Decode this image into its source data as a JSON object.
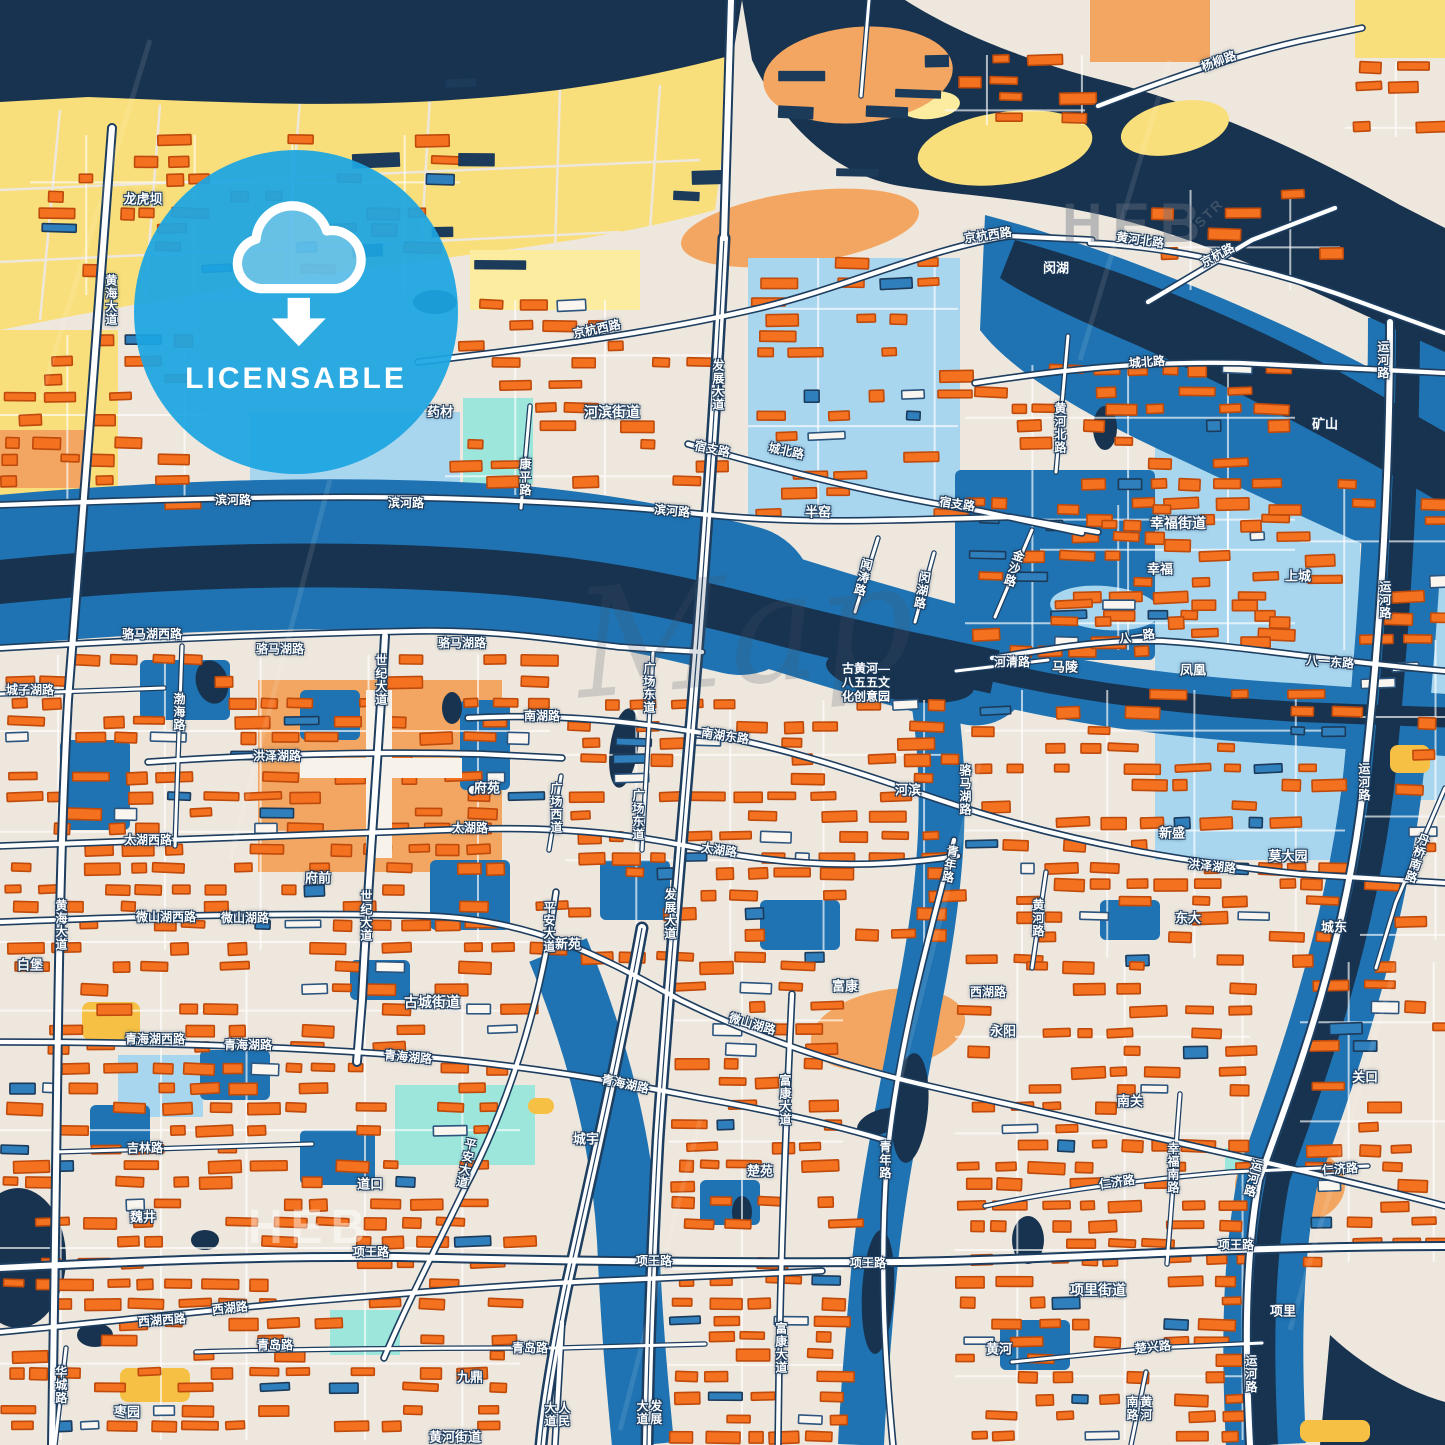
{
  "badge": {
    "label": "LICENSABLE",
    "icon": "cloud-download-icon",
    "color": "#1CA5E2"
  },
  "palette": {
    "land": "#EEE7DD",
    "yellow": "#F9DF7B",
    "yellow_light": "#FBEC9F",
    "gold": "#F5C043",
    "orange": "#F4711F",
    "orange_stroke": "#BE4A0C",
    "peach": "#F2A661",
    "navy": "#18334F",
    "navy_building": "#1C3A5A",
    "blue": "#1F73B2",
    "blue_light": "#A9D6EF",
    "cyan": "#9CE6DC",
    "white": "#FFFFFF",
    "road_casing": "#1E3E60",
    "label_glow": "#1B3A5C",
    "badge_blue": "#1CA5E2"
  },
  "watermarks": [
    {
      "text": "HEB",
      "x": 1062,
      "y": 190,
      "size": 56,
      "color": "rgba(105,115,130,0.40)",
      "ls": 10,
      "rot": 0,
      "serif": false
    },
    {
      "text": "STR",
      "x": 1192,
      "y": 205,
      "size": 14,
      "color": "rgba(105,115,130,0.45)",
      "ls": 2,
      "rot": -45,
      "serif": false
    },
    {
      "text": "Map",
      "x": 575,
      "y": 545,
      "size": 150,
      "color": "rgba(70,85,105,0.20)",
      "ls": 0,
      "rot": -5,
      "serif": true
    },
    {
      "text": "HEB",
      "x": 248,
      "y": 1200,
      "size": 48,
      "color": "rgba(255,255,255,0.45)",
      "ls": 8,
      "rot": 0,
      "serif": false
    }
  ],
  "labels": [
    {
      "t": "龙虎坝",
      "x": 143,
      "y": 200,
      "s": 13
    },
    {
      "t": "黄海大道",
      "x": 110,
      "y": 300,
      "v": 1
    },
    {
      "t": "杨柳路",
      "x": 1219,
      "y": 62,
      "r": -20
    },
    {
      "t": "京杭西路",
      "x": 597,
      "y": 330,
      "r": -12
    },
    {
      "t": "京杭西路",
      "x": 988,
      "y": 236,
      "r": -8
    },
    {
      "t": "黄河北路",
      "x": 1140,
      "y": 241,
      "r": 8
    },
    {
      "t": "京杭路",
      "x": 1218,
      "y": 256,
      "r": -28
    },
    {
      "t": "闵湖",
      "x": 1056,
      "y": 269,
      "s": 13
    },
    {
      "t": "药材",
      "x": 440,
      "y": 413,
      "s": 13
    },
    {
      "t": "河滨街道",
      "x": 612,
      "y": 412,
      "s": 14
    },
    {
      "t": "发展大道",
      "x": 717,
      "y": 385,
      "v": 1
    },
    {
      "t": "康平路",
      "x": 524,
      "y": 477,
      "v": 1
    },
    {
      "t": "宿支路",
      "x": 712,
      "y": 450,
      "r": 12
    },
    {
      "t": "城北路",
      "x": 786,
      "y": 452,
      "r": 12
    },
    {
      "t": "宿支路",
      "x": 957,
      "y": 505,
      "r": 8
    },
    {
      "t": "滨河路",
      "x": 233,
      "y": 501
    },
    {
      "t": "滨河路",
      "x": 406,
      "y": 504
    },
    {
      "t": "滨河路",
      "x": 672,
      "y": 512,
      "r": 5
    },
    {
      "t": "城北路",
      "x": 1147,
      "y": 363,
      "r": -4
    },
    {
      "t": "黄河北路",
      "x": 1059,
      "y": 428,
      "v": 1
    },
    {
      "t": "矿山",
      "x": 1325,
      "y": 425,
      "s": 13
    },
    {
      "t": "运河路",
      "x": 1382,
      "y": 360,
      "v": 1
    },
    {
      "t": "幸福街道",
      "x": 1178,
      "y": 523,
      "s": 14
    },
    {
      "t": "幸福",
      "x": 1160,
      "y": 570,
      "s": 13
    },
    {
      "t": "上城",
      "x": 1298,
      "y": 577,
      "s": 13
    },
    {
      "t": "金沙路",
      "x": 1013,
      "y": 568,
      "v": 1,
      "r": 18
    },
    {
      "t": "闻涛路",
      "x": 862,
      "y": 577,
      "v": 1,
      "r": 14
    },
    {
      "t": "闵湖路",
      "x": 921,
      "y": 590,
      "v": 1,
      "r": 10
    },
    {
      "t": "半窑",
      "x": 818,
      "y": 513,
      "s": 13
    },
    {
      "t": "骆马湖西路",
      "x": 152,
      "y": 635
    },
    {
      "t": "骆马湖路",
      "x": 280,
      "y": 650
    },
    {
      "t": "骆马湖路",
      "x": 462,
      "y": 644
    },
    {
      "t": "城子湖路",
      "x": 30,
      "y": 691
    },
    {
      "t": "渤海路",
      "x": 178,
      "y": 712,
      "v": 1
    },
    {
      "t": "世纪大道",
      "x": 380,
      "y": 680,
      "v": 1
    },
    {
      "t": "南湖路",
      "x": 542,
      "y": 717
    },
    {
      "t": "广场东道",
      "x": 648,
      "y": 688,
      "v": 1
    },
    {
      "t": "广场东道",
      "x": 637,
      "y": 815,
      "v": 1
    },
    {
      "t": "广场西道",
      "x": 555,
      "y": 808,
      "v": 1
    },
    {
      "t": "南湖东路",
      "x": 725,
      "y": 737,
      "r": 8
    },
    {
      "t": "河滨",
      "x": 908,
      "y": 791,
      "s": 13
    },
    {
      "t": "古黄河—\n八五五文\n化创意园",
      "x": 866,
      "y": 683,
      "ml": 1
    },
    {
      "t": "八一路",
      "x": 1137,
      "y": 637,
      "r": -8
    },
    {
      "t": "河清路",
      "x": 1012,
      "y": 663
    },
    {
      "t": "马陵",
      "x": 1065,
      "y": 668,
      "s": 13
    },
    {
      "t": "凤凰",
      "x": 1193,
      "y": 671,
      "s": 13
    },
    {
      "t": "八一东路",
      "x": 1330,
      "y": 663,
      "r": 4
    },
    {
      "t": "运河路",
      "x": 1384,
      "y": 600,
      "v": 1
    },
    {
      "t": "洪泽湖路",
      "x": 277,
      "y": 757
    },
    {
      "t": "太湖西路",
      "x": 148,
      "y": 841
    },
    {
      "t": "府前",
      "x": 318,
      "y": 879,
      "s": 13
    },
    {
      "t": "府苑",
      "x": 487,
      "y": 789,
      "s": 13
    },
    {
      "t": "太湖路",
      "x": 470,
      "y": 829
    },
    {
      "t": "太湖路",
      "x": 719,
      "y": 851,
      "r": 8
    },
    {
      "t": "洪泽湖路",
      "x": 1212,
      "y": 867,
      "r": 6
    },
    {
      "t": "新盛",
      "x": 1172,
      "y": 834,
      "s": 13
    },
    {
      "t": "莫大园",
      "x": 1288,
      "y": 857,
      "s": 13
    },
    {
      "t": "东大",
      "x": 1188,
      "y": 919,
      "s": 13
    },
    {
      "t": "城东",
      "x": 1334,
      "y": 928,
      "s": 13
    },
    {
      "t": "微山湖西路",
      "x": 166,
      "y": 918
    },
    {
      "t": "微山湖路",
      "x": 245,
      "y": 919
    },
    {
      "t": "微山湖路",
      "x": 752,
      "y": 1025,
      "r": 16
    },
    {
      "t": "世纪大道",
      "x": 365,
      "y": 916,
      "v": 1
    },
    {
      "t": "黄海大道",
      "x": 60,
      "y": 925,
      "v": 1
    },
    {
      "t": "平安大道",
      "x": 548,
      "y": 927,
      "v": 1
    },
    {
      "t": "新苑",
      "x": 568,
      "y": 945,
      "s": 13
    },
    {
      "t": "青年路",
      "x": 949,
      "y": 864,
      "v": 1,
      "r": 10
    },
    {
      "t": "运河路",
      "x": 1363,
      "y": 782,
      "v": 1
    },
    {
      "t": "丹桥南路",
      "x": 1416,
      "y": 858,
      "v": 1,
      "r": 18
    },
    {
      "t": "黄河路",
      "x": 1037,
      "y": 918,
      "v": 1
    },
    {
      "t": "骆马湖路",
      "x": 964,
      "y": 790,
      "v": 1
    },
    {
      "t": "白堡",
      "x": 30,
      "y": 966,
      "s": 13
    },
    {
      "t": "西湖路",
      "x": 988,
      "y": 993
    },
    {
      "t": "永阳",
      "x": 1003,
      "y": 1032,
      "s": 13
    },
    {
      "t": "富康",
      "x": 845,
      "y": 987,
      "s": 13
    },
    {
      "t": "古城街道",
      "x": 432,
      "y": 1002,
      "s": 14
    },
    {
      "t": "青海湖西路",
      "x": 155,
      "y": 1040
    },
    {
      "t": "青海湖路",
      "x": 248,
      "y": 1046
    },
    {
      "t": "青海湖路",
      "x": 408,
      "y": 1058,
      "r": 5
    },
    {
      "t": "青海湖路",
      "x": 625,
      "y": 1085,
      "r": 12
    },
    {
      "t": "城宇",
      "x": 586,
      "y": 1140,
      "s": 13
    },
    {
      "t": "楚苑",
      "x": 760,
      "y": 1172,
      "s": 13
    },
    {
      "t": "富康大道",
      "x": 784,
      "y": 1100,
      "v": 1
    },
    {
      "t": "吉林路",
      "x": 145,
      "y": 1149
    },
    {
      "t": "魏井",
      "x": 143,
      "y": 1218,
      "s": 13
    },
    {
      "t": "道口",
      "x": 370,
      "y": 1185,
      "s": 13
    },
    {
      "t": "平安大道",
      "x": 465,
      "y": 1163,
      "v": 1,
      "r": 12
    },
    {
      "t": "项王路",
      "x": 371,
      "y": 1253
    },
    {
      "t": "项王路",
      "x": 654,
      "y": 1262
    },
    {
      "t": "项王路",
      "x": 868,
      "y": 1264
    },
    {
      "t": "项王路",
      "x": 1236,
      "y": 1246
    },
    {
      "t": "南关",
      "x": 1130,
      "y": 1102,
      "s": 13
    },
    {
      "t": "关口",
      "x": 1365,
      "y": 1078,
      "s": 13
    },
    {
      "t": "仁济路",
      "x": 1117,
      "y": 1183,
      "r": -8
    },
    {
      "t": "仁济路",
      "x": 1340,
      "y": 1170,
      "r": -4
    },
    {
      "t": "幸福南路",
      "x": 1172,
      "y": 1168,
      "v": 1
    },
    {
      "t": "运河路",
      "x": 1252,
      "y": 1178,
      "v": 1,
      "r": 14
    },
    {
      "t": "项里街道",
      "x": 1098,
      "y": 1290,
      "s": 14
    },
    {
      "t": "项里",
      "x": 1283,
      "y": 1312,
      "s": 13
    },
    {
      "t": "西湖路",
      "x": 230,
      "y": 1309,
      "r": -6
    },
    {
      "t": "西湖西路",
      "x": 162,
      "y": 1321,
      "r": -4
    },
    {
      "t": "青岛路",
      "x": 275,
      "y": 1346
    },
    {
      "t": "青岛路",
      "x": 530,
      "y": 1349
    },
    {
      "t": "九鼎",
      "x": 470,
      "y": 1378,
      "s": 13
    },
    {
      "t": "人民大道",
      "x": 556,
      "y": 1414,
      "v": 1
    },
    {
      "t": "发展大道",
      "x": 648,
      "y": 1412,
      "v": 1
    },
    {
      "t": "发展大道",
      "x": 669,
      "y": 914,
      "v": 1
    },
    {
      "t": "富康大道",
      "x": 780,
      "y": 1348,
      "v": 1
    },
    {
      "t": "黄河",
      "x": 999,
      "y": 1350,
      "s": 13
    },
    {
      "t": "楚兴路",
      "x": 1153,
      "y": 1348,
      "r": -6
    },
    {
      "t": "黄河南路",
      "x": 1138,
      "y": 1408,
      "v": 1
    },
    {
      "t": "华城路",
      "x": 60,
      "y": 1385,
      "v": 1
    },
    {
      "t": "枣园",
      "x": 127,
      "y": 1413,
      "s": 13
    },
    {
      "t": "青年路",
      "x": 884,
      "y": 1160,
      "v": 1
    },
    {
      "t": "运河路",
      "x": 1250,
      "y": 1374,
      "v": 1
    },
    {
      "t": "黄河街道",
      "x": 455,
      "y": 1438,
      "s": 13
    }
  ]
}
